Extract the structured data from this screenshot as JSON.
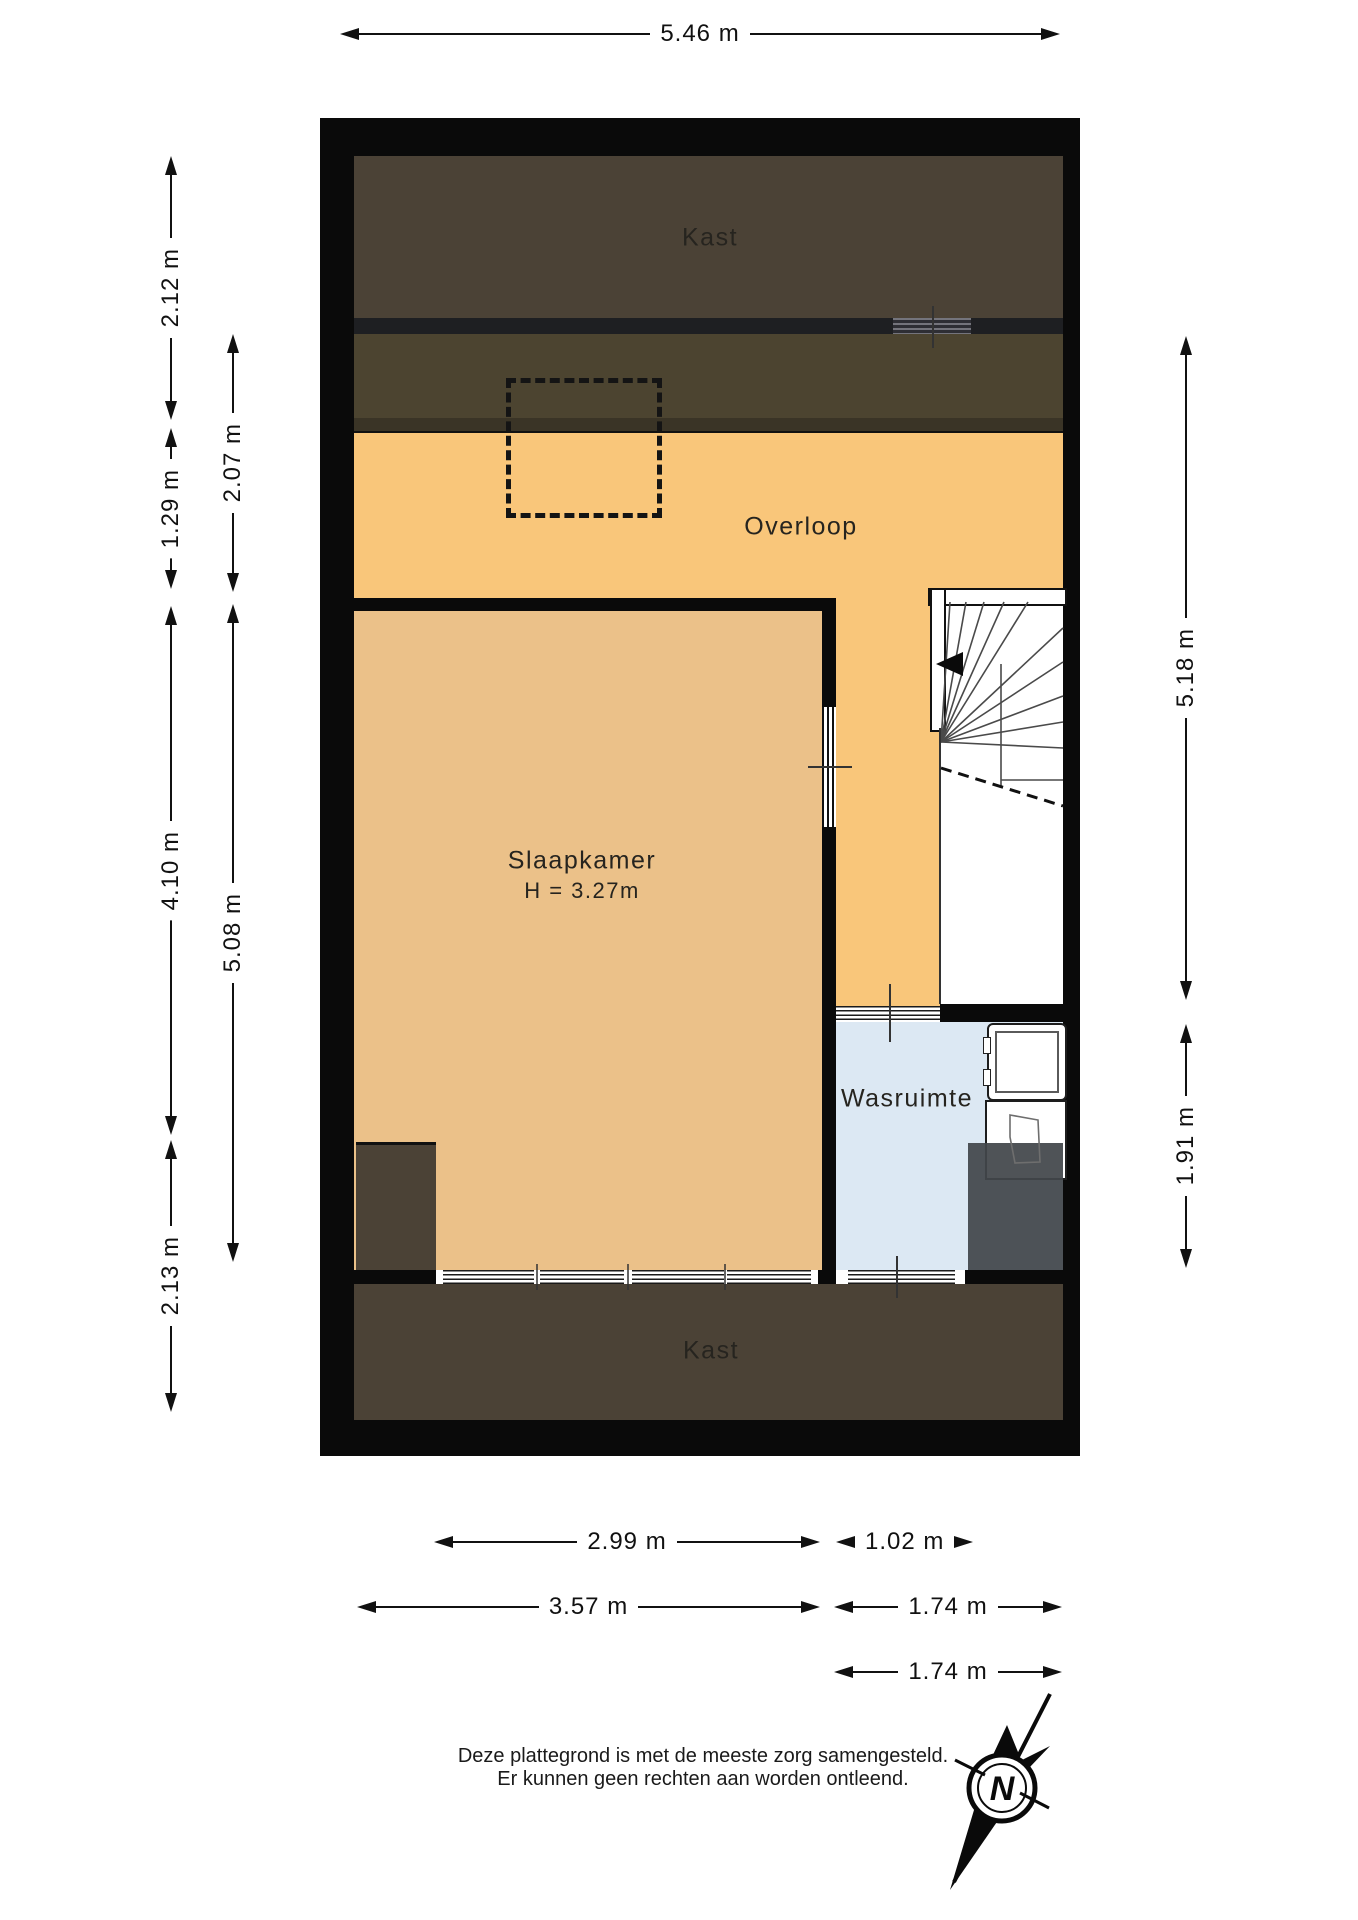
{
  "plan": {
    "rooms": [
      {
        "id": "kast-top",
        "label": "Kast",
        "x": 710,
        "y": 238,
        "fs": 25
      },
      {
        "id": "overloop",
        "label": "Overloop",
        "x": 801,
        "y": 527,
        "fs": 25
      },
      {
        "id": "slaapkamer",
        "label": "Slaapkamer",
        "x": 582,
        "y": 861,
        "fs": 25
      },
      {
        "id": "slaapkamer-height",
        "label": "H = 3.27m",
        "x": 582,
        "y": 891,
        "fs": 22
      },
      {
        "id": "wasruimte",
        "label": "Wasruimte",
        "x": 907,
        "y": 1099,
        "fs": 25
      },
      {
        "id": "kast-bottom",
        "label": "Kast",
        "x": 711,
        "y": 1351,
        "fs": 25
      }
    ],
    "dimensions": [
      {
        "id": "top-width",
        "dir": "h",
        "x1": 340,
        "x2": 1060,
        "y": 34,
        "label": "5.46 m"
      },
      {
        "id": "left-212",
        "dir": "v",
        "y1": 156,
        "y2": 420,
        "x": 171,
        "label": "2.12 m"
      },
      {
        "id": "left-129",
        "dir": "v",
        "y1": 428,
        "y2": 589,
        "x": 171,
        "label": "1.29 m"
      },
      {
        "id": "left-410",
        "dir": "v",
        "y1": 606,
        "y2": 1135,
        "x": 171,
        "label": "4.10 m"
      },
      {
        "id": "left-213",
        "dir": "v",
        "y1": 1140,
        "y2": 1412,
        "x": 171,
        "label": "2.13 m"
      },
      {
        "id": "inner-207",
        "dir": "v",
        "y1": 334,
        "y2": 592,
        "x": 233,
        "label": "2.07 m"
      },
      {
        "id": "inner-508",
        "dir": "v",
        "y1": 604,
        "y2": 1262,
        "x": 233,
        "label": "5.08 m"
      },
      {
        "id": "right-518",
        "dir": "v",
        "y1": 336,
        "y2": 1000,
        "x": 1186,
        "label": "5.18 m"
      },
      {
        "id": "right-191",
        "dir": "v",
        "y1": 1024,
        "y2": 1268,
        "x": 1186,
        "label": "1.91 m"
      },
      {
        "id": "bottom-299",
        "dir": "h",
        "x1": 434,
        "x2": 820,
        "y": 1542,
        "label": "2.99 m"
      },
      {
        "id": "bottom-102",
        "dir": "h",
        "x1": 836,
        "x2": 965,
        "y": 1542,
        "label": "1.02 m"
      },
      {
        "id": "bottom-357",
        "dir": "h",
        "x1": 357,
        "x2": 820,
        "y": 1607,
        "label": "3.57 m"
      },
      {
        "id": "bottom-174-upper",
        "dir": "h",
        "x1": 834,
        "x2": 1062,
        "y": 1607,
        "label": "1.74 m"
      },
      {
        "id": "bottom-174-lower",
        "dir": "h",
        "x1": 834,
        "x2": 1062,
        "y": 1672,
        "label": "1.74 m"
      }
    ],
    "disclaimer": [
      "Deze plattegrond is met de meeste zorg samengesteld.",
      "Er kunnen geen rechten aan worden ontleend."
    ],
    "compass": {
      "letter": "N"
    },
    "colors": {
      "wall": "#0a0a0a",
      "closet": "#4b4236",
      "slope": "#4c4430",
      "slope_edge": "#3a3426",
      "landing": "#f9c67a",
      "bedroom": "#ebc189",
      "laundry": "#dce8f3",
      "under_stairs": "#45484c"
    }
  }
}
